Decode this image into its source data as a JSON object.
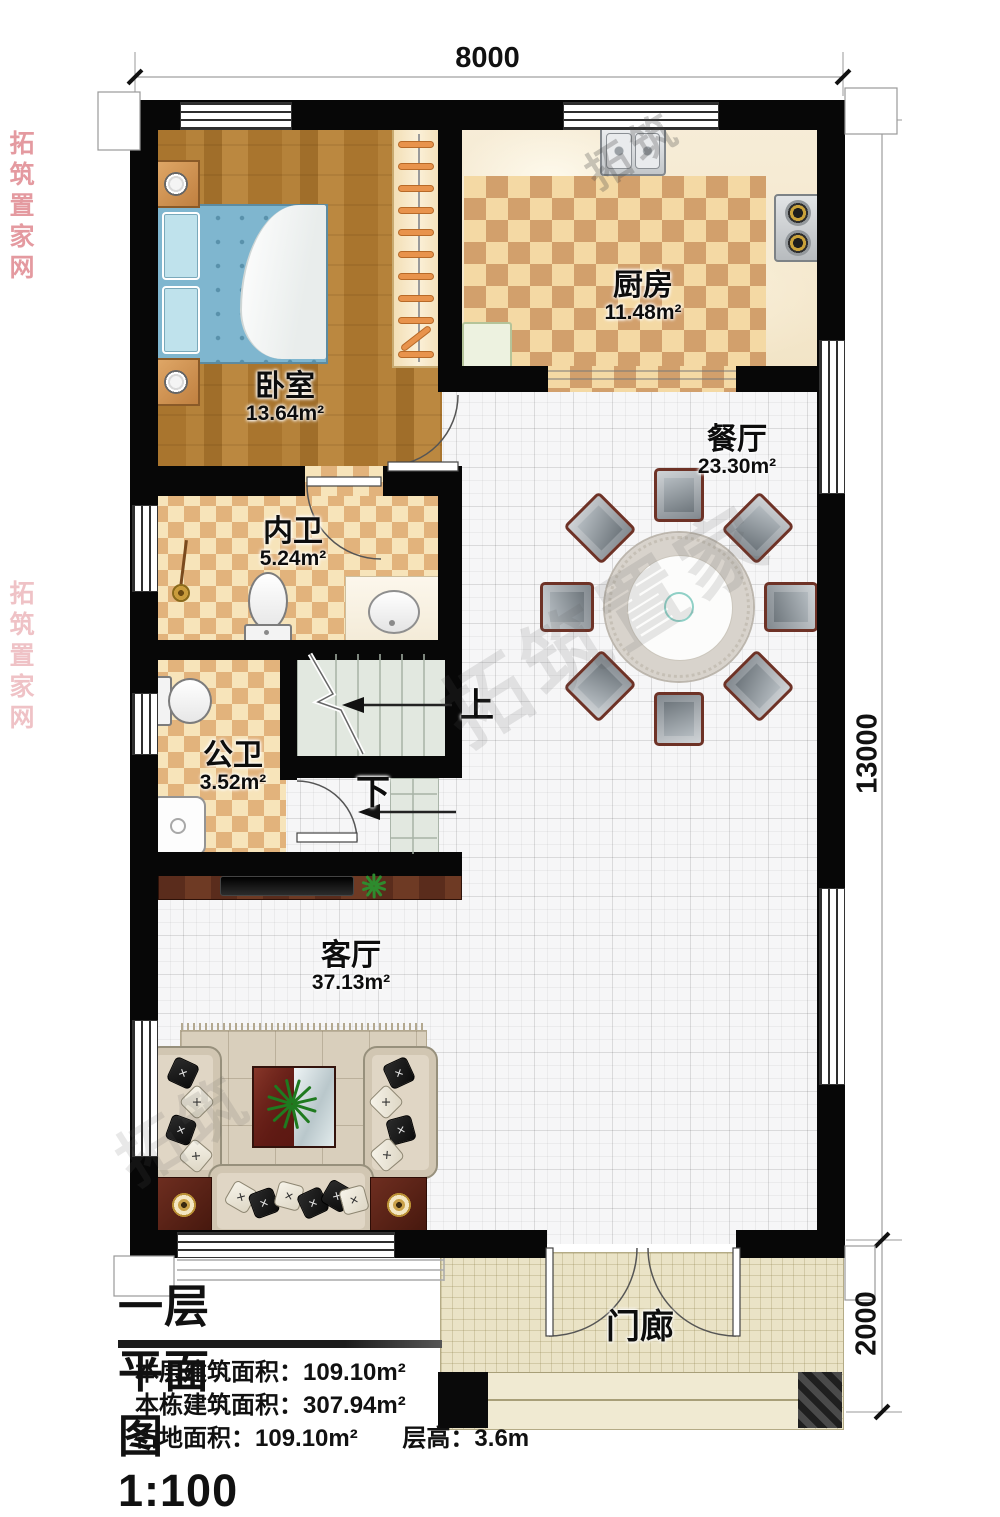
{
  "plan": {
    "title": "一层平面图1:100",
    "stats": [
      {
        "label": "本层建筑面积：",
        "value": "109.10m²"
      },
      {
        "label": "本栋建筑面积：",
        "value": "307.94m²"
      },
      {
        "label": "占地面积：",
        "value": "109.10m²",
        "label2": "层高：",
        "value2": "3.6m"
      }
    ]
  },
  "rooms": {
    "bedroom": {
      "name": "卧室",
      "area": "13.64m²"
    },
    "kitchen": {
      "name": "厨房",
      "area": "11.48m²"
    },
    "dining": {
      "name": "餐厅",
      "area": "23.30m²"
    },
    "bath_inner": {
      "name": "内卫",
      "area": "5.24m²"
    },
    "bath_public": {
      "name": "公卫",
      "area": "3.52m²"
    },
    "living": {
      "name": "客厅",
      "area": "37.13m²"
    },
    "porch": {
      "name": "门廊"
    }
  },
  "stairs": {
    "up_label": "上",
    "down_label": "下",
    "chair_count": 8
  },
  "dining_set": {
    "chairs": 8
  },
  "dimensions": {
    "width_top": "8000",
    "height_right": "13000",
    "porch_depth": "2000"
  },
  "watermarks": {
    "red_vertical": "拓筑置家网",
    "diagonal_main": "拓筑置家",
    "diagonal_small": "拓筑"
  },
  "colors": {
    "wall": "#070707",
    "wood_floor": "#ad7930",
    "tile_dark": "#d2a06c",
    "tile_light": "#f4d9a4",
    "stair": "#e2e8e0",
    "porch": "#eae3c6",
    "accent_red": "#6e1f1a",
    "table_teal": "#8fd0c6"
  }
}
